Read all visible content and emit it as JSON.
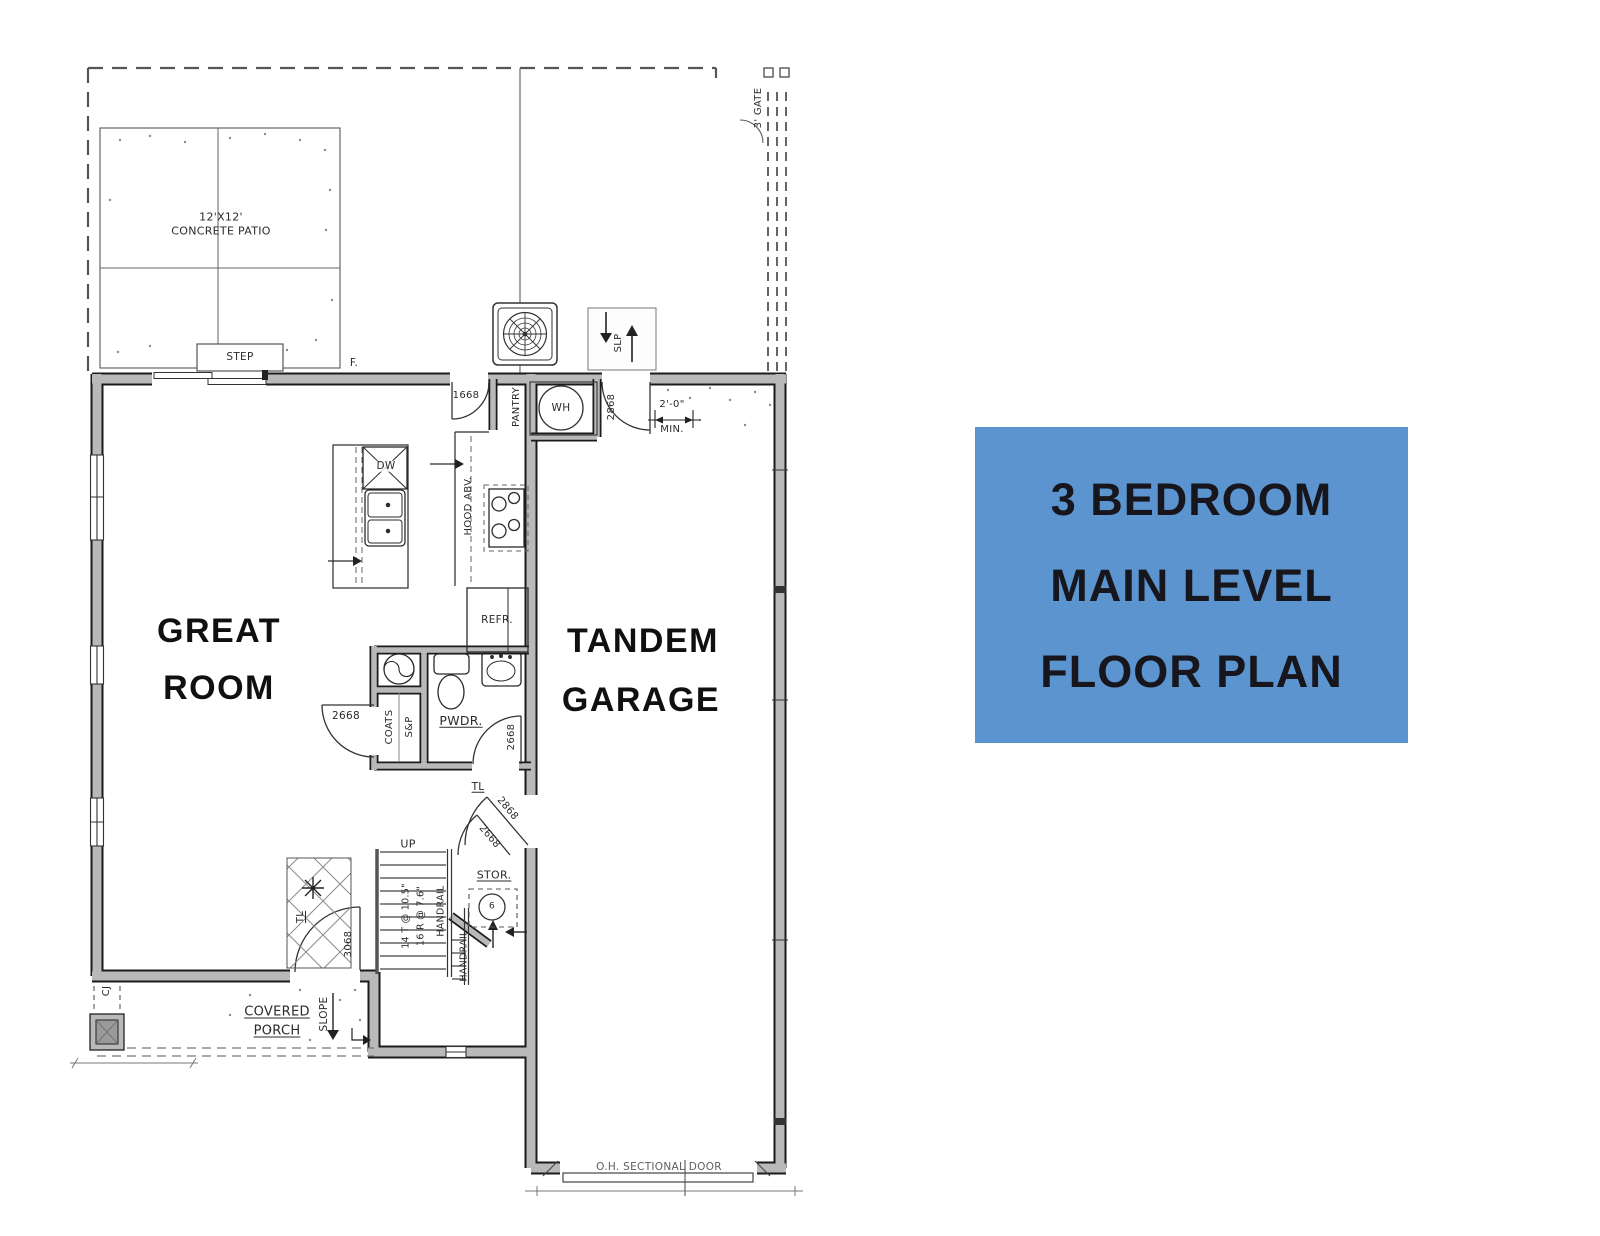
{
  "title_card": {
    "line1": "3 BEDROOM",
    "line2": "MAIN LEVEL",
    "line3": "FLOOR PLAN",
    "bg_color": "#5b94ce",
    "text_color": "#16161c"
  },
  "rooms": {
    "great_line1": "GREAT",
    "great_line2": "ROOM",
    "garage_line1": "TANDEM",
    "garage_line2": "GARAGE",
    "powder": "PWDR.",
    "storage": "STOR.",
    "coats": "COATS",
    "shelf_pole": "S&P",
    "pantry": "PANTRY",
    "porch_line1": "COVERED",
    "porch_line2": "PORCH"
  },
  "site": {
    "patio_line1": "12'X12'",
    "patio_line2": "CONCRETE PATIO",
    "step": "STEP",
    "gate": "3' GATE",
    "footing": "F.",
    "stoop_slope": "SLP",
    "porch_slope": "SLOPE",
    "control_joint": "CJ"
  },
  "finishes": {
    "tile_hall": "TL",
    "tile_entry": "TL"
  },
  "appliances": {
    "dishwasher": "DW",
    "water_heater": "WH",
    "refrigerator": "REFR.",
    "hood": "HOOD ABV.",
    "furnace": "6"
  },
  "doors": {
    "pantry": "1668",
    "garage_entry": "2868",
    "coats": "2668",
    "powder": "2668",
    "hall_garage": "2868",
    "storage": "2668",
    "front": "3068",
    "overhead": "O.H. SECTIONAL DOOR"
  },
  "stairs": {
    "up": "UP",
    "treads": "14 T @ 10.5\"",
    "risers": "16 R @ 7.6\"",
    "handrail_a": "HANDRAIL",
    "handrail_b": "HANDRAIL"
  },
  "dimensions": {
    "min_width": "2'-0\"",
    "min_label": "MIN."
  },
  "colors": {
    "card_bg": "#5b94ce",
    "card_text": "#16161c",
    "ink": "#2b2b2b",
    "wall_fill": "#b9b9b9"
  }
}
